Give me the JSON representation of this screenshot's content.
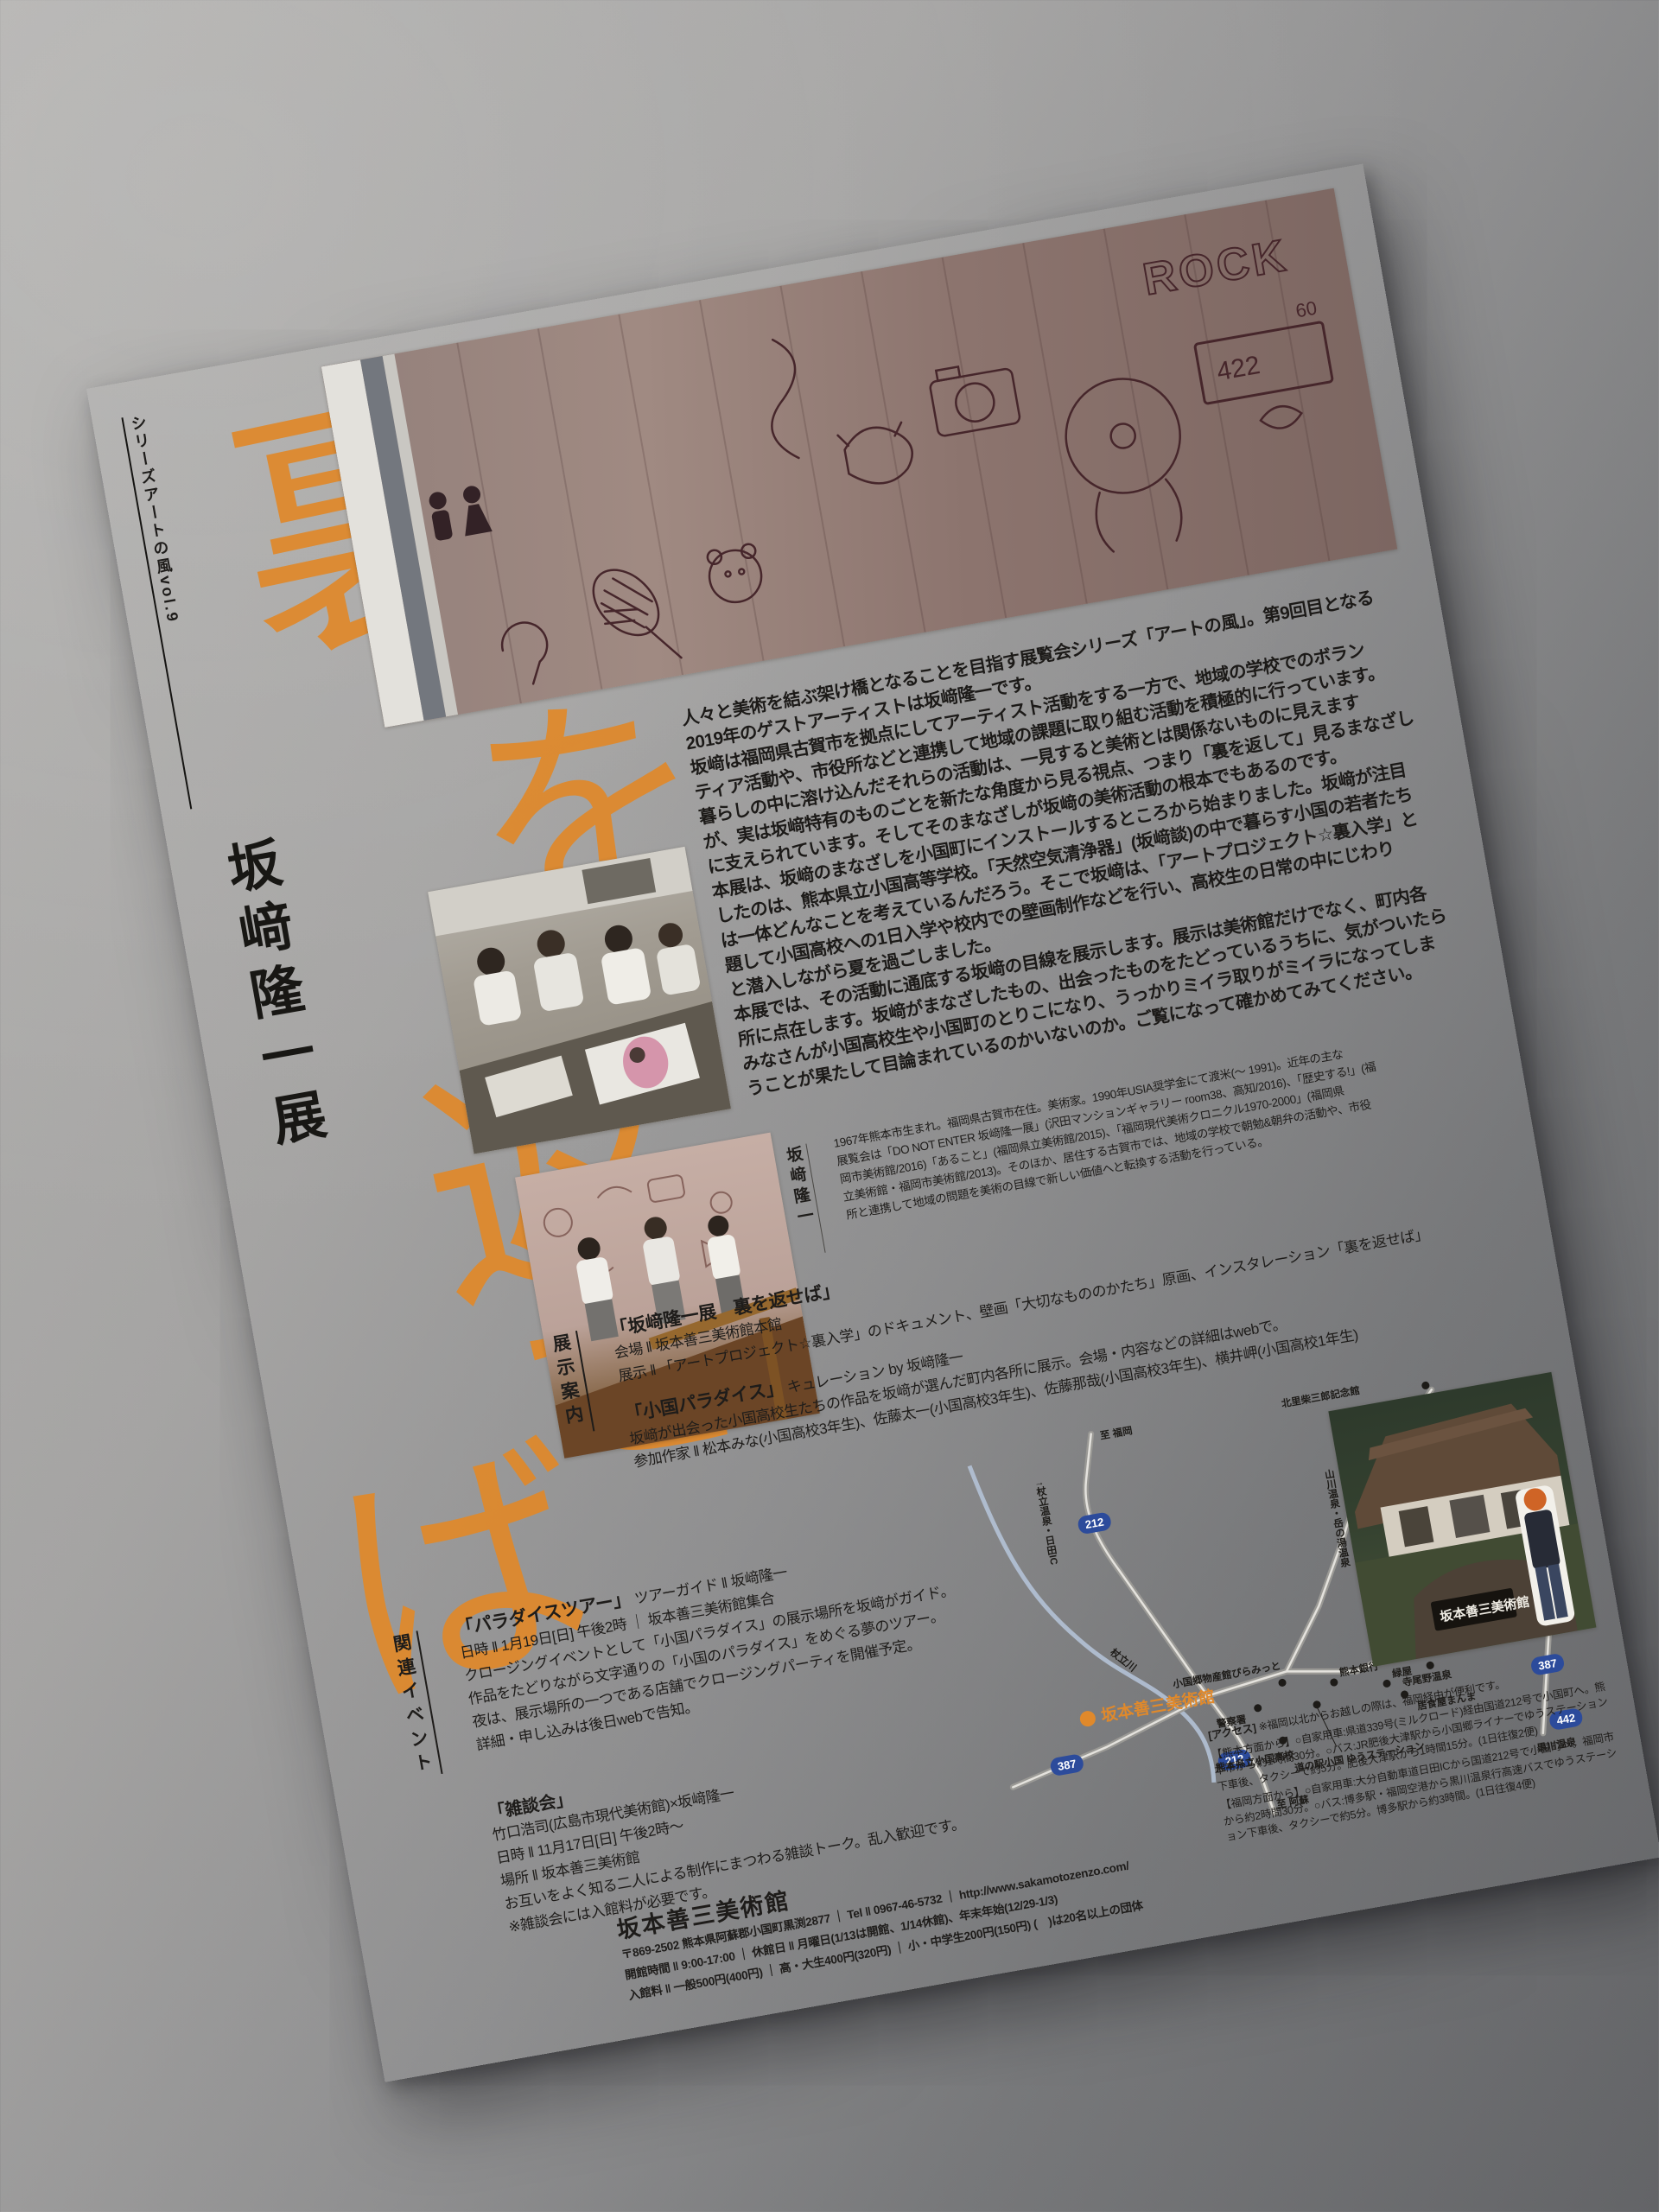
{
  "flyer": {
    "series_label": "シリーズアートの風vol.9",
    "exhibition_title": "坂﨑隆一展",
    "main_title": "裏を返せば",
    "title_chars": [
      "裏",
      "を",
      "返",
      "せ",
      "ば"
    ],
    "accent_color": "#e0892b"
  },
  "intro": {
    "lines": [
      "人々と美術を結ぶ架け橋となることを目指す展覧会シリーズ「アートの風」。第9回目となる",
      "2019年のゲストアーティストは坂﨑隆一です。",
      "坂﨑は福岡県古賀市を拠点にしてアーティスト活動をする一方で、地域の学校でのボラン",
      "ティア活動や、市役所などと連携して地域の課題に取り組む活動を積極的に行っています。",
      "暮らしの中に溶け込んだそれらの活動は、一見すると美術とは関係ないものに見えます",
      "が、実は坂﨑特有のものごとを新たな角度から見る視点、つまり「裏を返して」見るまなざし",
      "に支えられています。そしてそのまなざしが坂﨑の美術活動の根本でもあるのです。",
      "本展は、坂﨑のまなざしを小国町にインストールするところから始まりました。坂﨑が注目",
      "したのは、熊本県立小国高等学校。「天然空気清浄器」(坂﨑談)の中で暮らす小国の若者たち",
      "は一体どんなことを考えているんだろう。そこで坂﨑は、「アートプロジェクト☆裏入学」と",
      "題して小国高校への1日入学や校内での壁画制作などを行い、高校生の日常の中にじわり",
      "と潜入しながら夏を過ごしました。",
      "本展では、その活動に通底する坂﨑の目線を展示します。展示は美術館だけでなく、町内各",
      "所に点在します。坂﨑がまなざしたもの、出会ったものをたどっているうちに、気がついたら",
      "みなさんが小国高校生や小国町のとりこになり、うっかりミイラ取りがミイラになってしま",
      "うことが果たして目論まれているのかいないのか。ご覧になって確かめてみてください。"
    ]
  },
  "bio": {
    "label": "坂﨑隆一",
    "lines": [
      "1967年熊本市生まれ。福岡県古賀市在住。美術家。1990年USIA奨学金にて渡米(〜 1991)。近年の主な",
      "展覧会は「DO NOT ENTER 坂﨑隆一展」(沢田マンションギャラリー room38、高知/2016)、「歴史する!」(福",
      "岡市美術館/2016)「あること」(福岡県立美術館/2015)、「福岡現代美術クロニクル1970-2000」(福岡県",
      "立美術館・福岡市美術館/2013)。そのほか、居住する古賀市では、地域の学校で朝勉&朝弁の活動や、市役",
      "所と連携して地域の問題を美術の目線で新しい価値へと転換する活動を行っている。"
    ]
  },
  "exhibits": {
    "section_label": "展示案内",
    "show1": {
      "title": "「坂﨑隆一展　裏を返せば」",
      "venue": "会場 ‖ 坂本善三美術館本館",
      "display": "展示 ‖ 「アートプロジェクト☆裏入学」のドキュメント、壁画「大切なもののかたち」原画、インスタレーション「裏を返せば」"
    },
    "show2": {
      "title": "「小国パラダイス」",
      "curation": "キュレーション by 坂﨑隆一",
      "description": "坂﨑が出会った小国高校生たちの作品を坂﨑が選んだ町内各所に展示。会場・内容などの詳細はwebで。",
      "artists": "参加作家 ‖ 松本みな(小国高校3年生)、佐藤太一(小国高校3年生)、佐藤那哉(小国高校3年生)、横井岬(小国高校1年生)"
    }
  },
  "events": {
    "section_label": "関連イベント",
    "tour": {
      "title": "「パラダイスツアー」",
      "guide": "ツアーガイド ‖ 坂﨑隆一",
      "datetime": "日時 ‖ 1月19日[日] 午後2時 ｜ 坂本善三美術館集合",
      "lines": [
        "クロージングイベントとして「小国パラダイス」の展示場所を坂﨑がガイド。",
        "作品をたどりながら文字通りの「小国のパラダイス」をめぐる夢のツアー。",
        "夜は、展示場所の一つである店舗でクロージングパーティを開催予定。",
        "詳細・申し込みは後日webで告知。"
      ]
    },
    "chat": {
      "title": "「雑談会」",
      "speakers": "竹口浩司(広島市現代美術館)×坂﨑隆一",
      "datetime": "日時 ‖ 11月17日[日] 午後2時〜",
      "place": "場所 ‖ 坂本善三美術館",
      "description": "お互いをよく知る二人による制作にまつわる雑談トーク。乱入歓迎です。",
      "note": "※雑談会には入館料が必要です。"
    }
  },
  "map": {
    "museum": "坂本善三美術館",
    "route_212": "212",
    "route_387": "387",
    "route_442": "442",
    "to_fukuoka": "至 福岡",
    "tsuetate": "↑杖立温泉・日田IC",
    "river": "杖立川",
    "kitasato": "北里柴三郎記念館",
    "yamakawa": "山川温泉・岳の湯温泉",
    "teranoyu": "寺尾野温泉",
    "pyramid": "小国郷物産館ぴらみっと",
    "bank": "熊本銀行",
    "police": "警察署",
    "school": "熊本県立小国高校",
    "station": "道の駅小国 ゆうステーション",
    "midoriya": "緑屋",
    "manma": "居食屋まんま",
    "kurokawa": "黒川温泉",
    "to_aso": "至 阿蘇"
  },
  "access": {
    "label": "[アクセス]",
    "note": "※福岡以北からお越しの際は、福岡経由が便利です。",
    "from_kumamoto": "【熊本方面から】○自家用車:県道339号(ミルクロード)経由国道212号で小国町へ。熊本市から約1時間30分。○バス:JR肥後大津駅から小国郷ライナーでゆうステーション下車後、タクシーで約5分。肥後大津駅から1時間15分。(1日往復2便)",
    "from_fukuoka": "【福岡方面から】○自家用車:大分自動車道日田ICから国道212号で小国町へ。福岡市から約2時間30分。○バス:博多駅・福岡空港から黒川温泉行高速バスでゆうステーション下車後、タクシーで約5分。博多駅から約3時間。(1日往復4便)"
  },
  "museum_info": {
    "name": "坂本善三美術館",
    "address_line": "〒869-2502 熊本県阿蘇郡小国町黒渕2877 ｜ Tel ‖ 0967-46-5732 ｜ http://www.sakamotozenzo.com/",
    "hours_line": "開館時間 ‖ 9:00-17:00 ｜ 休館日 ‖ 月曜日(1/13は開館、1/14休館)、年末年始(12/29-1/3)",
    "admission_line": "入館料 ‖ 一般500円(400円) ｜ 高・大生400円(320円) ｜ 小・中学生200円(150円) (　)は20名以上の団体"
  },
  "photos": {
    "mural_graffiti_rock": "ROCK",
    "mural_number_422": "422",
    "mural_number_60": "60",
    "museum_sign": "坂本善三美術館"
  }
}
